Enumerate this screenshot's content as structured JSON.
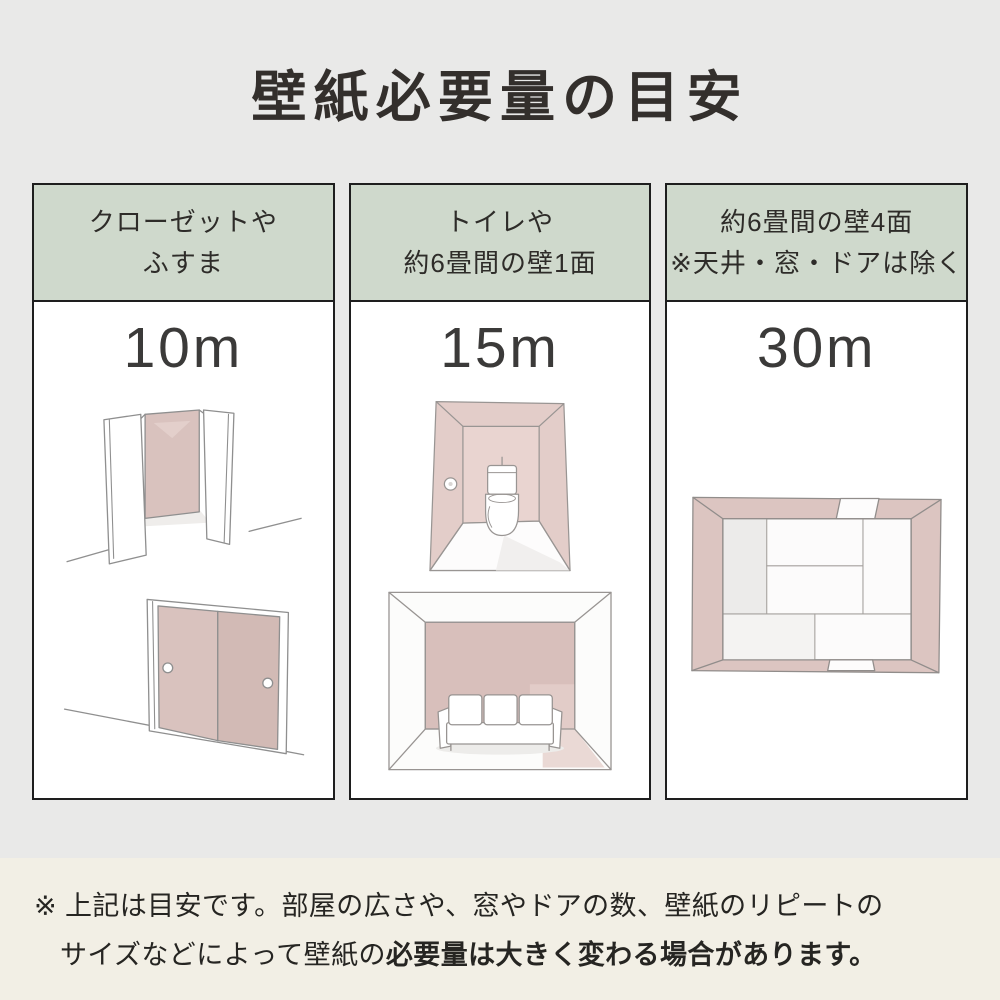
{
  "page": {
    "title": "壁紙必要量の目安"
  },
  "colors": {
    "top_background": "#e9e9e8",
    "footer_background": "#f2efe5",
    "header_green": "#cfd9cc",
    "card_border": "#1e1e1e",
    "wallpaper_pink": "#d9c2be",
    "wallpaper_pink_light": "#e8d4d0",
    "text_dark": "#332f2c"
  },
  "columns": [
    {
      "header_line1": "クローゼットや",
      "header_line2": "ふすま",
      "amount": "10m",
      "illustrations": [
        "open-closet",
        "fusuma-sliding-doors"
      ]
    },
    {
      "header_line1": "トイレや",
      "header_line2": "約6畳間の壁1面",
      "amount": "15m",
      "illustrations": [
        "toilet-room",
        "room-one-accent-wall-with-sofa"
      ]
    },
    {
      "header_line1": "約6畳間の壁4面",
      "header_line2": "※天井・窓・ドアは除く",
      "amount": "30m",
      "illustrations": [
        "six-tatami-room-top-view-four-walls"
      ]
    }
  ],
  "footnote": {
    "marker": "※",
    "line1": "上記は目安です。部屋の広さや、窓やドアの数、壁紙のリピートの",
    "line2_normal": "サイズなどによって壁紙の",
    "line2_bold": "必要量は大きく変わる場合があります。"
  }
}
